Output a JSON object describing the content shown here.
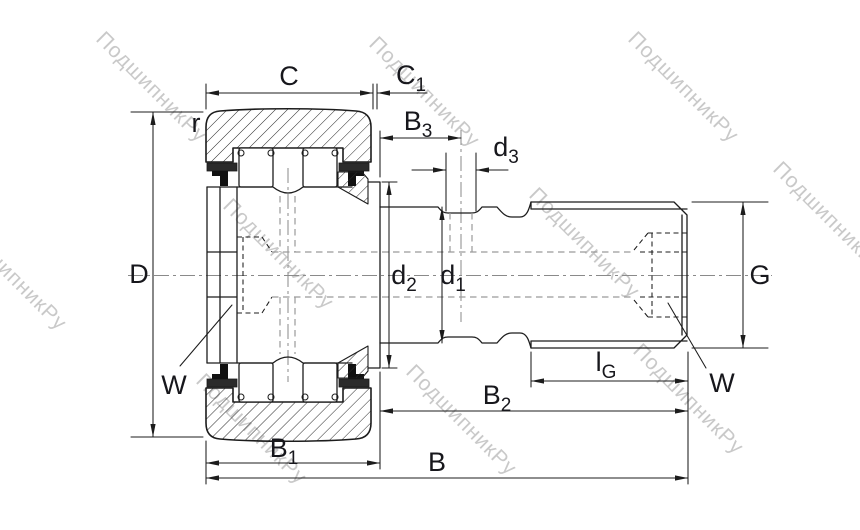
{
  "drawing": {
    "title_hint": "cam follower stud roller bearing cross-section",
    "watermark": {
      "text": "ПодшипникРу",
      "color": "#c9c9c9"
    },
    "colors": {
      "line": "#1c1c1c",
      "hidden_gray": "#9a9a9a",
      "centerline": "#8a8a8a",
      "background": "#ffffff"
    },
    "labels": {
      "C": {
        "main": "C",
        "sub": ""
      },
      "C1": {
        "main": "C",
        "sub": "1"
      },
      "B3": {
        "main": "B",
        "sub": "3"
      },
      "d3": {
        "main": "d",
        "sub": "3"
      },
      "D": {
        "main": "D",
        "sub": ""
      },
      "r": {
        "main": "r",
        "sub": ""
      },
      "d2": {
        "main": "d",
        "sub": "2"
      },
      "d1": {
        "main": "d",
        "sub": "1"
      },
      "G": {
        "main": "G",
        "sub": ""
      },
      "W_left": {
        "main": "W",
        "sub": ""
      },
      "W_right": {
        "main": "W",
        "sub": ""
      },
      "lG": {
        "main": "l",
        "sub": "G"
      },
      "B2": {
        "main": "B",
        "sub": "2"
      },
      "B1": {
        "main": "B",
        "sub": "1"
      },
      "B": {
        "main": "B",
        "sub": ""
      }
    }
  }
}
